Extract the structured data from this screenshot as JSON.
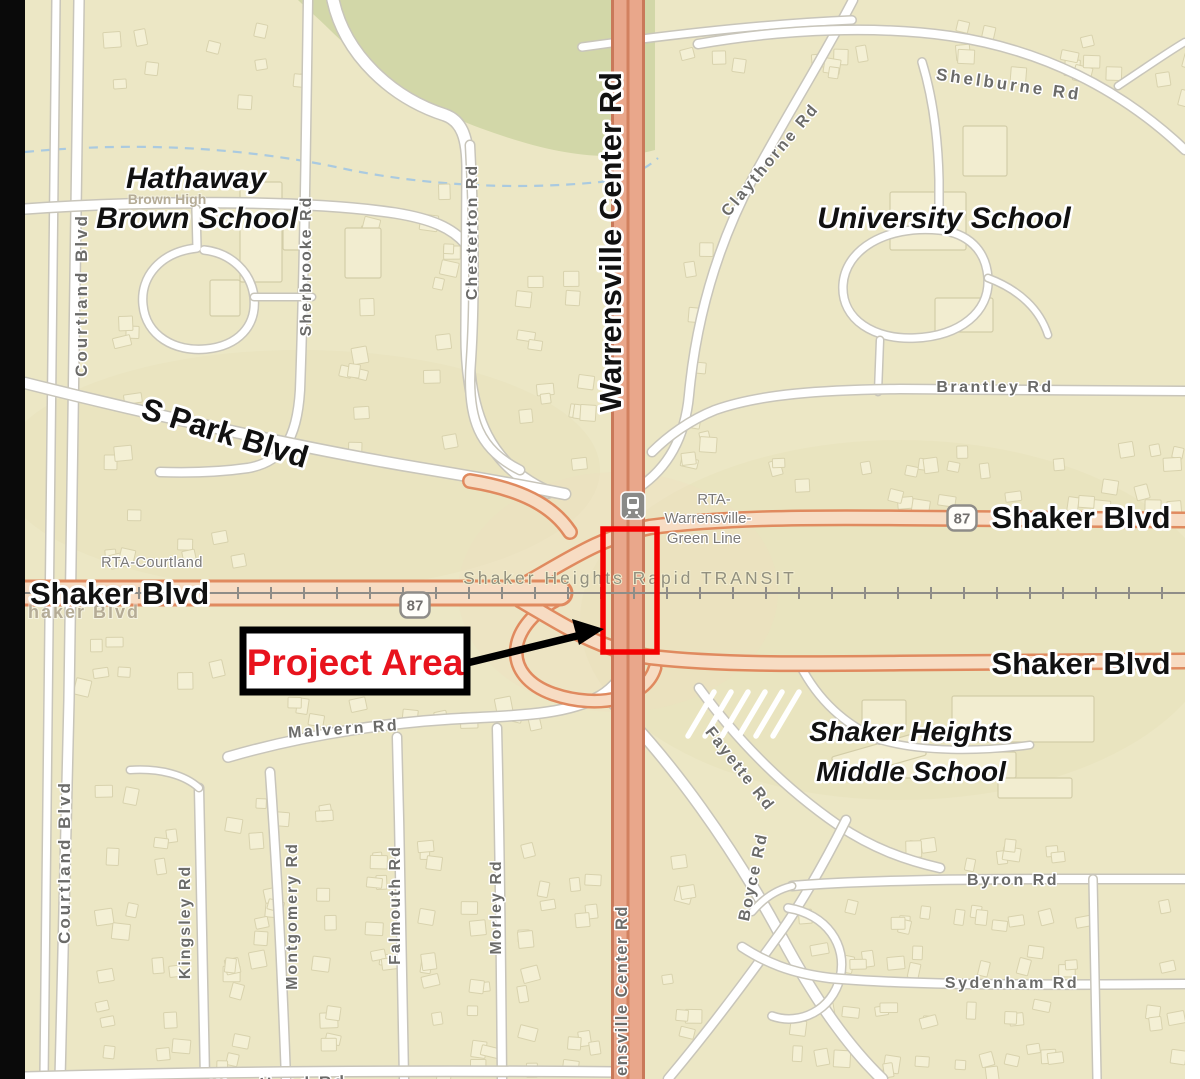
{
  "map": {
    "major_labels": {
      "warrensville_center_rd": "Warrensville Center Rd",
      "s_park_blvd": "S Park Blvd",
      "shaker_blvd_left": "Shaker Blvd",
      "shaker_blvd_upper_right": "Shaker Blvd",
      "shaker_blvd_lower_right": "Shaker Blvd"
    },
    "place_labels": {
      "hathaway_line1": "Hathaway",
      "hathaway_line2": "Brown School",
      "university_school": "University School",
      "middle_school_line1": "Shaker Heights",
      "middle_school_line2": "Middle School"
    },
    "street_labels": {
      "courtland_top": "Courtland Blvd",
      "courtland_bottom": "Courtland Blvd",
      "sherbrooke": "Sherbrooke Rd",
      "chesterton": "Chesterton Rd",
      "claythorne": "Claythorne Rd",
      "shelburne": "Shelburne Rd",
      "brantley": "Brantley Rd",
      "malvern": "Malvern Rd",
      "kingsley": "Kingsley Rd",
      "montgomery": "Montgomery Rd",
      "falmouth": "Falmouth Rd",
      "morley": "Morley Rd",
      "fayette": "Fayette Rd",
      "boyce": "Boyce Rd",
      "byron": "Byron Rd",
      "sydenham": "Sydenham Rd",
      "s_woodland": "S Woodland Rd",
      "warrensville_partial_bottom": "ensville Center Rd"
    },
    "transit_labels": {
      "rta_courtland": "RTA-Courtland",
      "rta_line1": "RTA-",
      "rta_line2": "Warrensville-",
      "rta_line3": "Green Line",
      "rapid_transit": "Shaker Heights Rapid TRANSIT"
    },
    "faint_labels": {
      "shaker_blvd_under": "haker Blvd",
      "brown_high": "Brown High"
    },
    "route_shields": {
      "shaker_87_left": "87",
      "shaker_87_right": "87"
    },
    "annotation": {
      "project_area": "Project Area"
    },
    "colors": {
      "land": "#ece7c5",
      "park_green": "#d2d7a8",
      "major_road_fill": "#e9a78b",
      "major_road_casing": "#c9795a",
      "shaker_fill": "#f7dcc3",
      "shaker_edge": "#e08a5f",
      "rail_gray": "#8f8d88",
      "highlight_red": "#f40000",
      "annotation_text_red": "#e8131d",
      "street_label_gray": "#6b6b69"
    }
  }
}
